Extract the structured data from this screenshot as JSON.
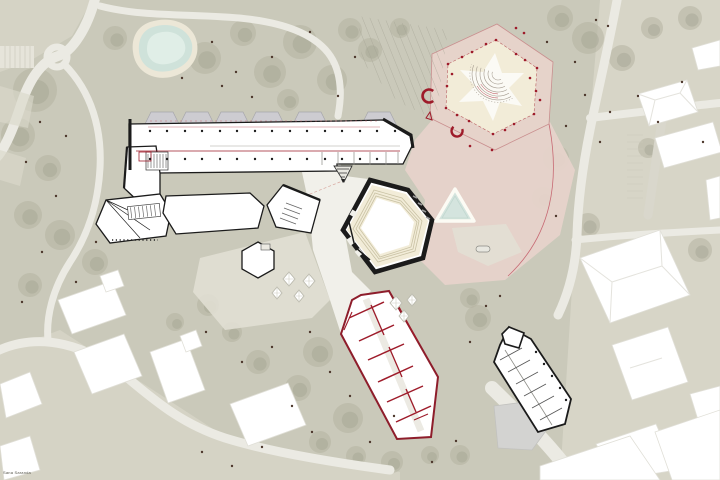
{
  "document": {
    "kind": "architectural-site-plan",
    "signature": "Sana Saranda"
  },
  "palette": {
    "bg": "#cac9ba",
    "park_light": "#dad8cb",
    "canopy": "#b4b3a1",
    "canopy_dark": "#a5a492",
    "trunk": "#4d372c",
    "road": "#ebeae3",
    "road_gray": "#d9d7cc",
    "water": "#cfe2da",
    "water_rim": "#ece7d7",
    "plaza_pink": "#e6d3ca",
    "cream": "#f2ecd8",
    "red": "#9e1b2a",
    "red_light": "#c76a74",
    "ink": "#1b1b1b",
    "gray_bldg": "#d3d3d1",
    "skylight": "#cdccd1"
  },
  "features": [
    "pond",
    "linear-gallery-building",
    "workshop-hexagons",
    "central-hexagon-hall",
    "event-plaza-hexagon",
    "amphitheater",
    "triangle-pool",
    "red-walled-building",
    "diagonal-outlined-building",
    "context-buildings",
    "roads",
    "park-trees",
    "terraces"
  ],
  "landscape": {
    "canopies": [
      [
        35,
        90,
        22
      ],
      [
        18,
        135,
        17
      ],
      [
        48,
        168,
        13
      ],
      [
        28,
        215,
        14
      ],
      [
        60,
        235,
        15
      ],
      [
        95,
        262,
        13
      ],
      [
        30,
        285,
        12
      ],
      [
        115,
        38,
        12
      ],
      [
        205,
        58,
        16
      ],
      [
        243,
        33,
        13
      ],
      [
        270,
        72,
        16
      ],
      [
        300,
        42,
        17
      ],
      [
        332,
        80,
        15
      ],
      [
        288,
        100,
        11
      ],
      [
        350,
        30,
        12
      ],
      [
        370,
        50,
        12
      ],
      [
        400,
        28,
        10
      ],
      [
        560,
        18,
        13
      ],
      [
        588,
        38,
        16
      ],
      [
        622,
        58,
        13
      ],
      [
        652,
        28,
        11
      ],
      [
        690,
        18,
        12
      ],
      [
        556,
        158,
        13
      ],
      [
        543,
        198,
        11
      ],
      [
        588,
        225,
        12
      ],
      [
        648,
        148,
        10
      ],
      [
        700,
        250,
        12
      ],
      [
        478,
        318,
        13
      ],
      [
        470,
        298,
        10
      ],
      [
        318,
        352,
        15
      ],
      [
        298,
        388,
        13
      ],
      [
        348,
        418,
        15
      ],
      [
        382,
        392,
        11
      ],
      [
        258,
        362,
        12
      ],
      [
        232,
        332,
        10
      ],
      [
        208,
        305,
        11
      ],
      [
        320,
        442,
        11
      ],
      [
        356,
        456,
        10
      ],
      [
        392,
        462,
        11
      ],
      [
        175,
        322,
        9
      ],
      [
        460,
        455,
        10
      ],
      [
        430,
        455,
        9
      ]
    ],
    "tree_dots": [
      [
        585,
        95
      ],
      [
        610,
        112
      ],
      [
        638,
        96
      ],
      [
        600,
        142
      ],
      [
        658,
        122
      ],
      [
        682,
        82
      ],
      [
        703,
        142
      ],
      [
        575,
        62
      ],
      [
        547,
        42
      ],
      [
        608,
        26
      ],
      [
        566,
        126
      ],
      [
        355,
        57
      ],
      [
        338,
        96
      ],
      [
        310,
        32
      ],
      [
        272,
        57
      ],
      [
        236,
        72
      ],
      [
        212,
        42
      ],
      [
        252,
        97
      ],
      [
        222,
        86
      ],
      [
        182,
        78
      ],
      [
        40,
        122
      ],
      [
        26,
        162
      ],
      [
        56,
        196
      ],
      [
        42,
        252
      ],
      [
        76,
        282
      ],
      [
        22,
        302
      ],
      [
        96,
        242
      ],
      [
        66,
        136
      ],
      [
        310,
        332
      ],
      [
        330,
        372
      ],
      [
        292,
        406
      ],
      [
        350,
        396
      ],
      [
        312,
        432
      ],
      [
        370,
        442
      ],
      [
        394,
        416
      ],
      [
        272,
        347
      ],
      [
        242,
        362
      ],
      [
        206,
        332
      ],
      [
        470,
        342
      ],
      [
        486,
        306
      ],
      [
        232,
        466
      ],
      [
        262,
        447
      ],
      [
        202,
        452
      ],
      [
        432,
        462
      ],
      [
        456,
        441
      ],
      [
        556,
        216
      ],
      [
        500,
        296
      ],
      [
        596,
        20
      ]
    ]
  }
}
